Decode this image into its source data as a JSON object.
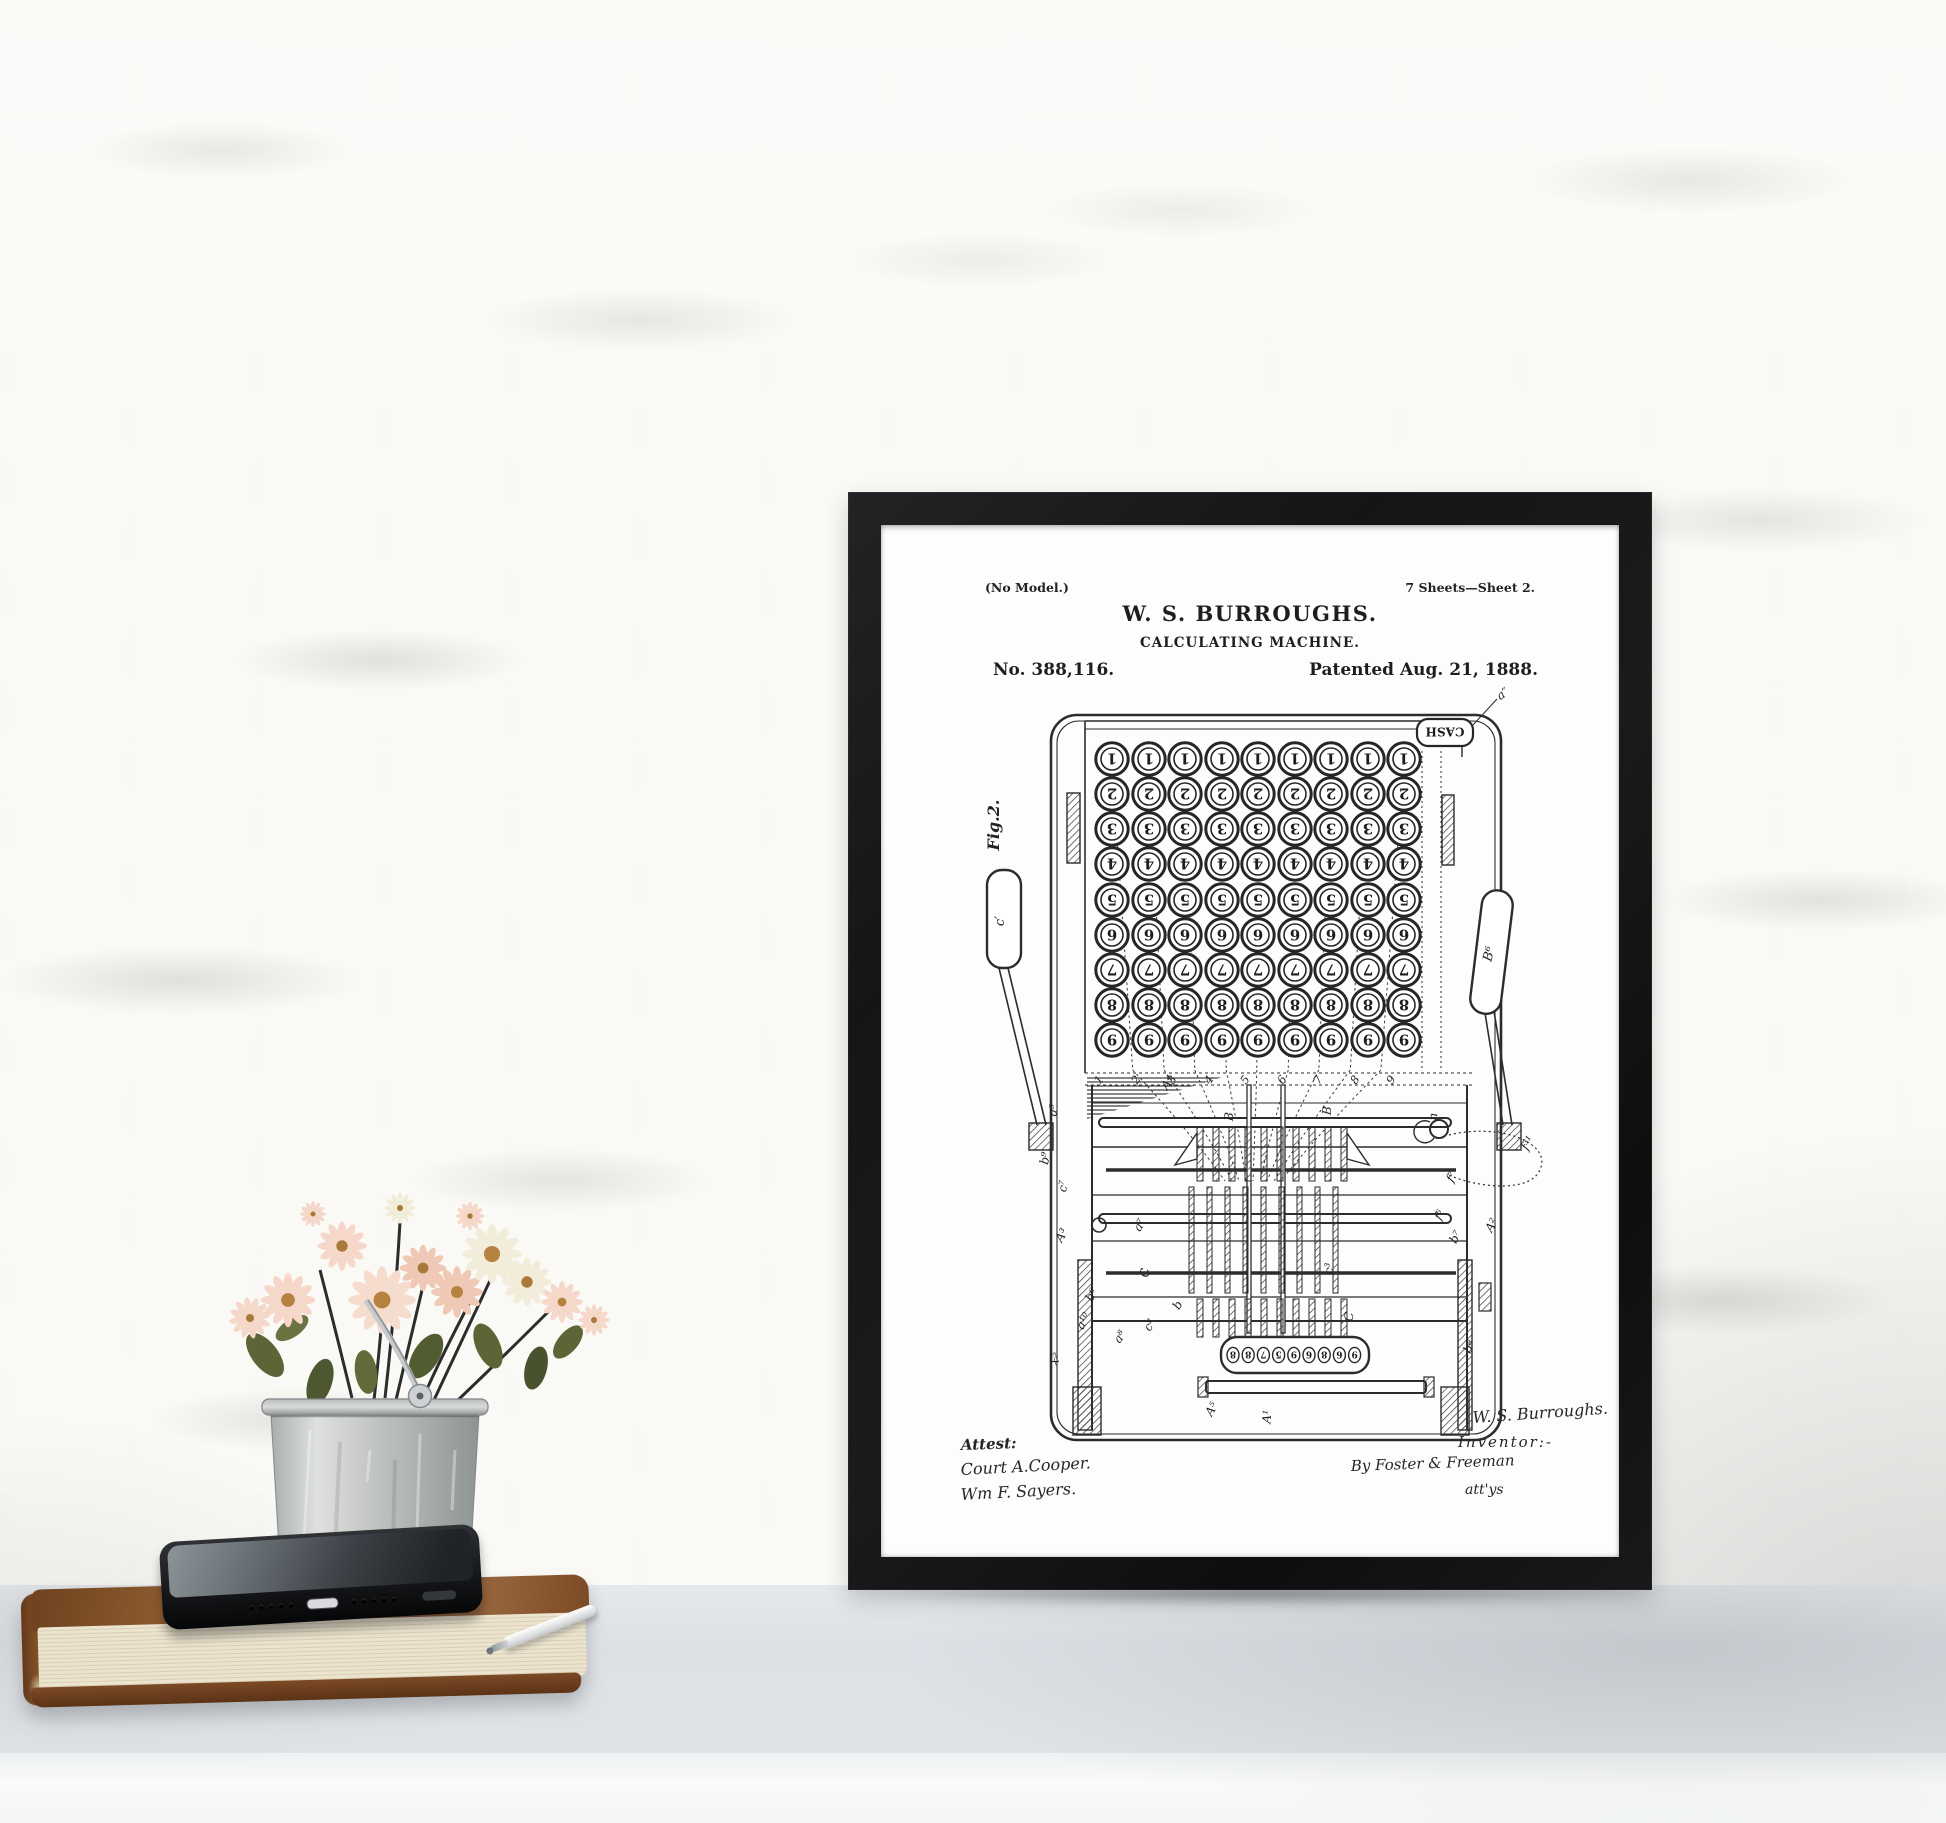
{
  "poster": {
    "no_model": "(No Model.)",
    "sheet_info": "7 Sheets—Sheet 2.",
    "title": "W. S. BURROUGHS.",
    "subtitle": "CALCULATING MACHINE.",
    "patent_number": "No. 388,116.",
    "patent_date": "Patented Aug. 21, 1888.",
    "fig_label": "Fig.2.",
    "cash_label": "CASH",
    "lever_left_label": "c′",
    "lever_right_label": "B⁶",
    "keyboard": {
      "rows": [
        "1",
        "2",
        "3",
        "4",
        "5",
        "6",
        "7",
        "8",
        "9"
      ],
      "columns": 9,
      "column_numbers": [
        "1",
        "2",
        "3",
        "4",
        "5",
        "6",
        "7",
        "8",
        "9"
      ]
    },
    "register_digits": [
      "8",
      "8",
      "7",
      "5",
      "9",
      "6",
      "8",
      "6",
      "9"
    ],
    "part_labels": [
      {
        "t": "a″",
        "x": 624,
        "y": 172,
        "r": -35
      },
      {
        "t": "A⁴",
        "x": 290,
        "y": 560,
        "r": -55
      },
      {
        "t": "a⁹",
        "x": 176,
        "y": 586,
        "r": -80
      },
      {
        "t": "b⁹",
        "x": 168,
        "y": 634,
        "r": -80
      },
      {
        "t": "c⁷",
        "x": 186,
        "y": 662,
        "r": -80
      },
      {
        "t": "A³",
        "x": 184,
        "y": 712,
        "r": -60
      },
      {
        "t": "a⁷",
        "x": 262,
        "y": 702,
        "r": -60
      },
      {
        "t": "C",
        "x": 268,
        "y": 748,
        "r": -85
      },
      {
        "t": "c²",
        "x": 272,
        "y": 802,
        "r": -60
      },
      {
        "t": "b",
        "x": 300,
        "y": 782,
        "r": -60
      },
      {
        "t": "a⁸",
        "x": 242,
        "y": 814,
        "r": -55
      },
      {
        "t": "x²",
        "x": 178,
        "y": 836,
        "r": -60
      },
      {
        "t": "a¹⁰",
        "x": 206,
        "y": 798,
        "r": -60
      },
      {
        "t": "b⁶",
        "x": 214,
        "y": 772,
        "r": -60
      },
      {
        "t": "B",
        "x": 352,
        "y": 592,
        "r": -85
      },
      {
        "t": "B",
        "x": 450,
        "y": 586,
        "r": -85
      },
      {
        "t": "c³",
        "x": 452,
        "y": 744,
        "r": -85
      },
      {
        "t": "C",
        "x": 472,
        "y": 792,
        "r": -85
      },
      {
        "t": "n",
        "x": 556,
        "y": 592,
        "r": -85
      },
      {
        "t": "f³¹",
        "x": 650,
        "y": 620,
        "r": -60
      },
      {
        "t": "f⁷",
        "x": 574,
        "y": 654,
        "r": -60
      },
      {
        "t": "f⁶",
        "x": 562,
        "y": 692,
        "r": -60
      },
      {
        "t": "b⁷",
        "x": 578,
        "y": 714,
        "r": -60
      },
      {
        "t": "A²",
        "x": 614,
        "y": 702,
        "r": -60
      },
      {
        "t": "b⁸",
        "x": 592,
        "y": 824,
        "r": -60
      },
      {
        "t": "A⁵",
        "x": 334,
        "y": 886,
        "r": -60
      },
      {
        "t": "A¹",
        "x": 390,
        "y": 892,
        "r": -85
      }
    ],
    "signatures": {
      "attest": "Attest:",
      "witness1": "Court A.Cooper.",
      "witness2": "Wm F. Sayers.",
      "inventor_sig": "W. S. Burroughs.",
      "inventor_label": "Inventor:-",
      "attorney": "By Foster & Freeman",
      "attorney_label": "att'ys"
    }
  },
  "colors": {
    "wall": "#eeebe6",
    "mortar": "#faf9f6",
    "desk": "#dfe3e7",
    "desk_front": "#fafbfb",
    "frame": "#151517",
    "paper": "#fdfdfc",
    "ink": "#2c2c2c",
    "flower_pink": "#f5d8c9",
    "flower_cream": "#f2ecdb",
    "flower_center": "#b5833f",
    "leaf": "#5d6536",
    "bucket": "#c2c5c2",
    "book": "#7c4a26",
    "book_pages": "#e8e0c9",
    "phone": "#17181b",
    "pen": "#e9eaea"
  }
}
